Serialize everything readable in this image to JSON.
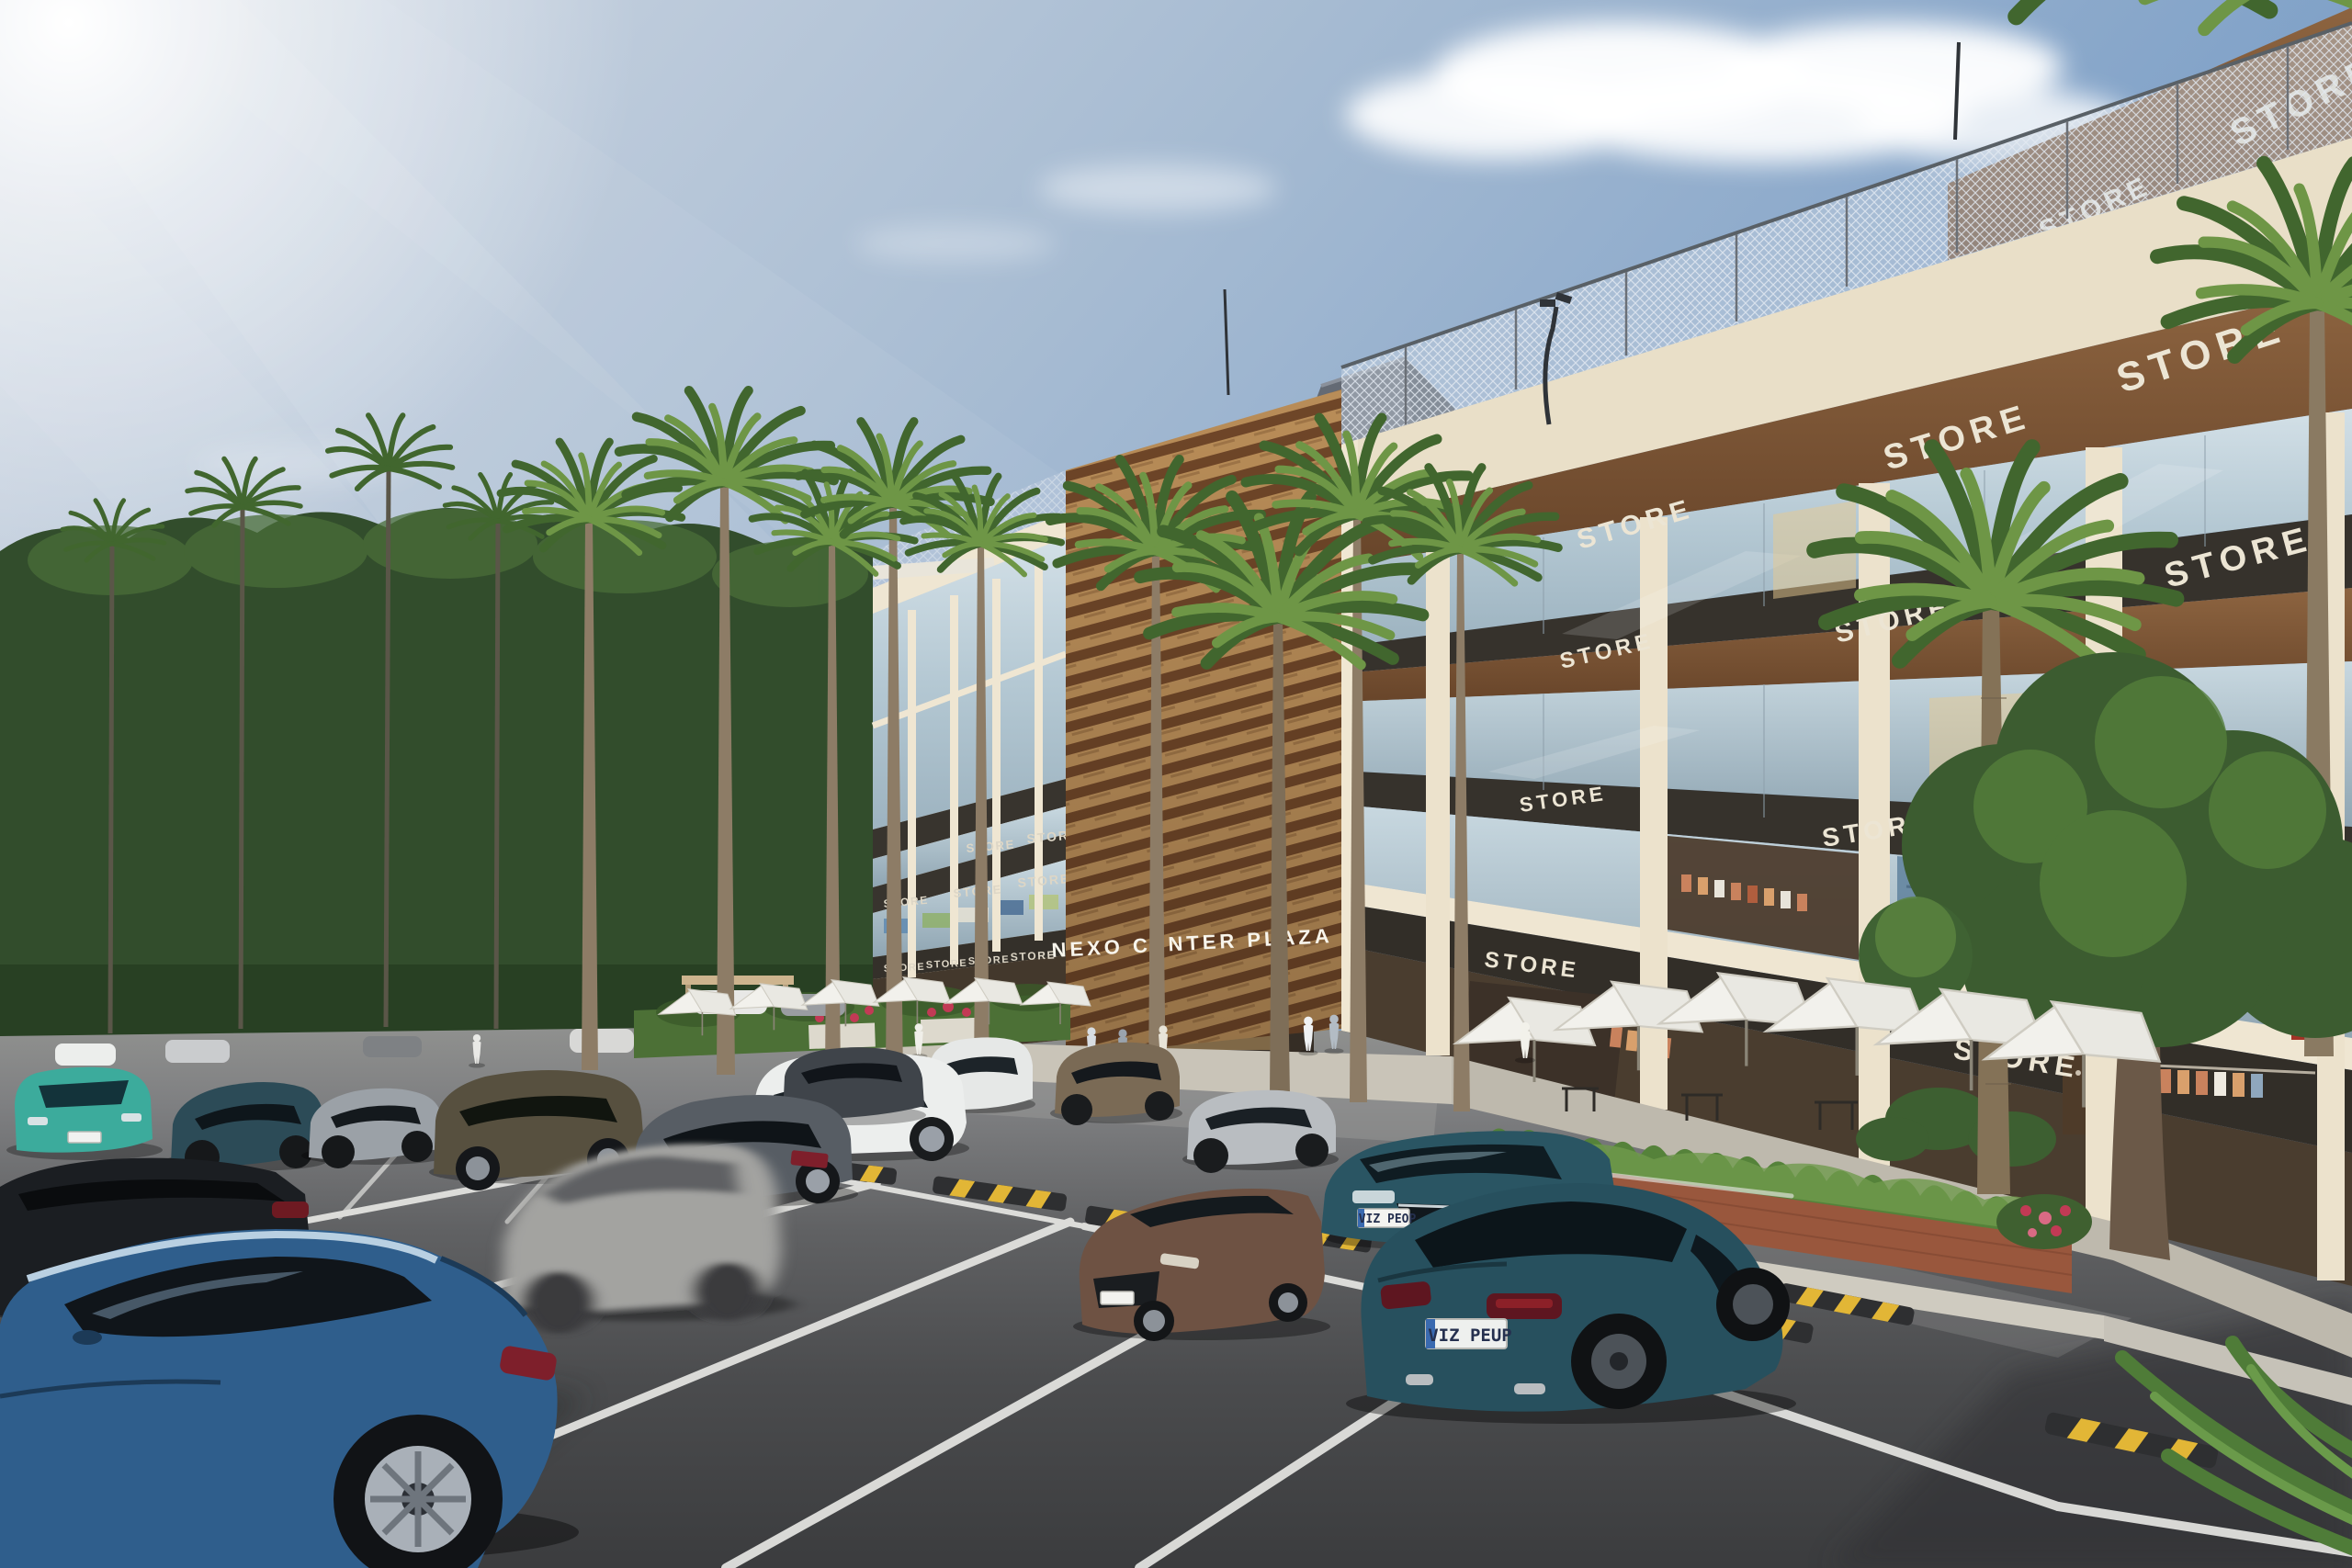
{
  "scene": {
    "type": "architectural-exterior-render",
    "setting": "shopping plaza with parking lot, palm trees and storefronts",
    "time_of_day": "daytime"
  },
  "signage": {
    "plaza_name": "NEXO CENTER PLAZA",
    "store_label": "STORE"
  },
  "vehicles": {
    "teal_sedan_rear_plate": "VIZ PEUP",
    "teal_sedan_front_plate": "VIZ PEOP"
  },
  "palette": {
    "sky_left": "#cdd6e2",
    "sky_right": "#7298c4",
    "sun": "#ffffff",
    "building_wall": "#e9dfc8",
    "wood_soffit": "#7b5836",
    "dark_fascia": "#36322c",
    "glass": "#c2d4dd",
    "asphalt_light": "#90918f",
    "asphalt_dark": "#3b3c3e",
    "parking_line": "#e6e6e3",
    "wheelstop_yellow": "#e2b636",
    "palm_green": "#6e9646",
    "tree_green": "#3c5c30",
    "car_teal": "#27505e",
    "car_blue": "#2f5e8c",
    "car_bronze": "#6e5243",
    "umbrella_white": "#f2f1ec",
    "planter_brick": "#99573d",
    "flower_red": "#c23a55"
  }
}
